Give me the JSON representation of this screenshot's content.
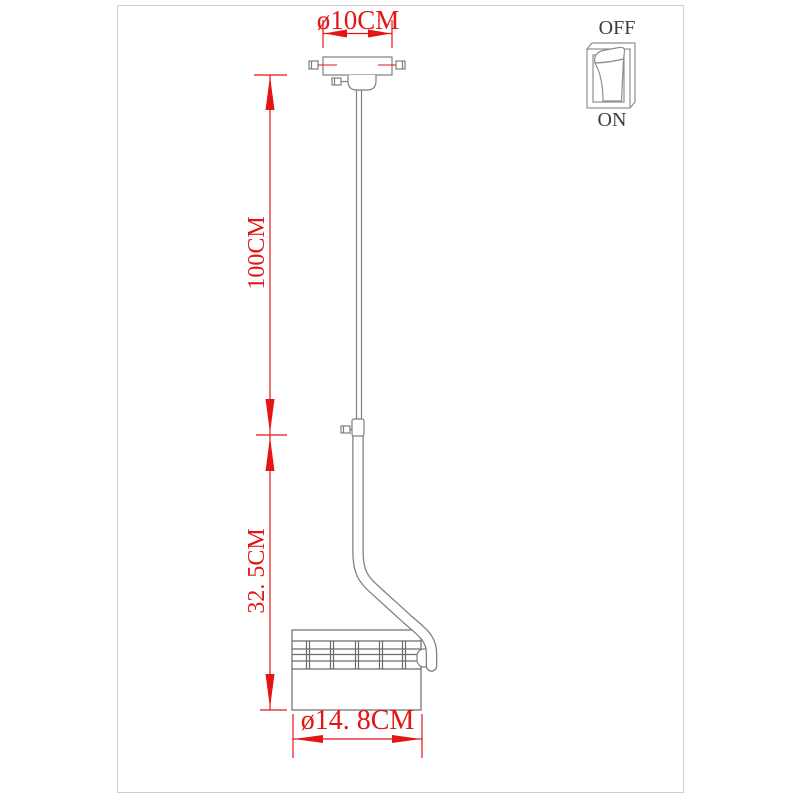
{
  "diagram": {
    "type": "pendant-lamp-dimension-drawing",
    "dimensions": {
      "canopy_diameter": "ø10CM",
      "suspension_length": "100CM",
      "fixture_height": "32. 5CM",
      "shade_diameter": "ø14. 8CM"
    },
    "switch": {
      "off_label": "OFF",
      "on_label": "ON"
    },
    "parts": [
      "ceiling-plate",
      "mounting-screws",
      "canopy-cup",
      "suspension-cable",
      "cable-connector",
      "curved-arm",
      "ribbed-lamp-shade",
      "rocker-switch"
    ],
    "colors": {
      "dimension_red": "#e31515",
      "line_gray": "#7f7f7f",
      "shade_gray": "#6a6a6a",
      "switch_text": "#3c3c3c",
      "frame_border": "#cfcfcf",
      "background": "#ffffff"
    }
  }
}
